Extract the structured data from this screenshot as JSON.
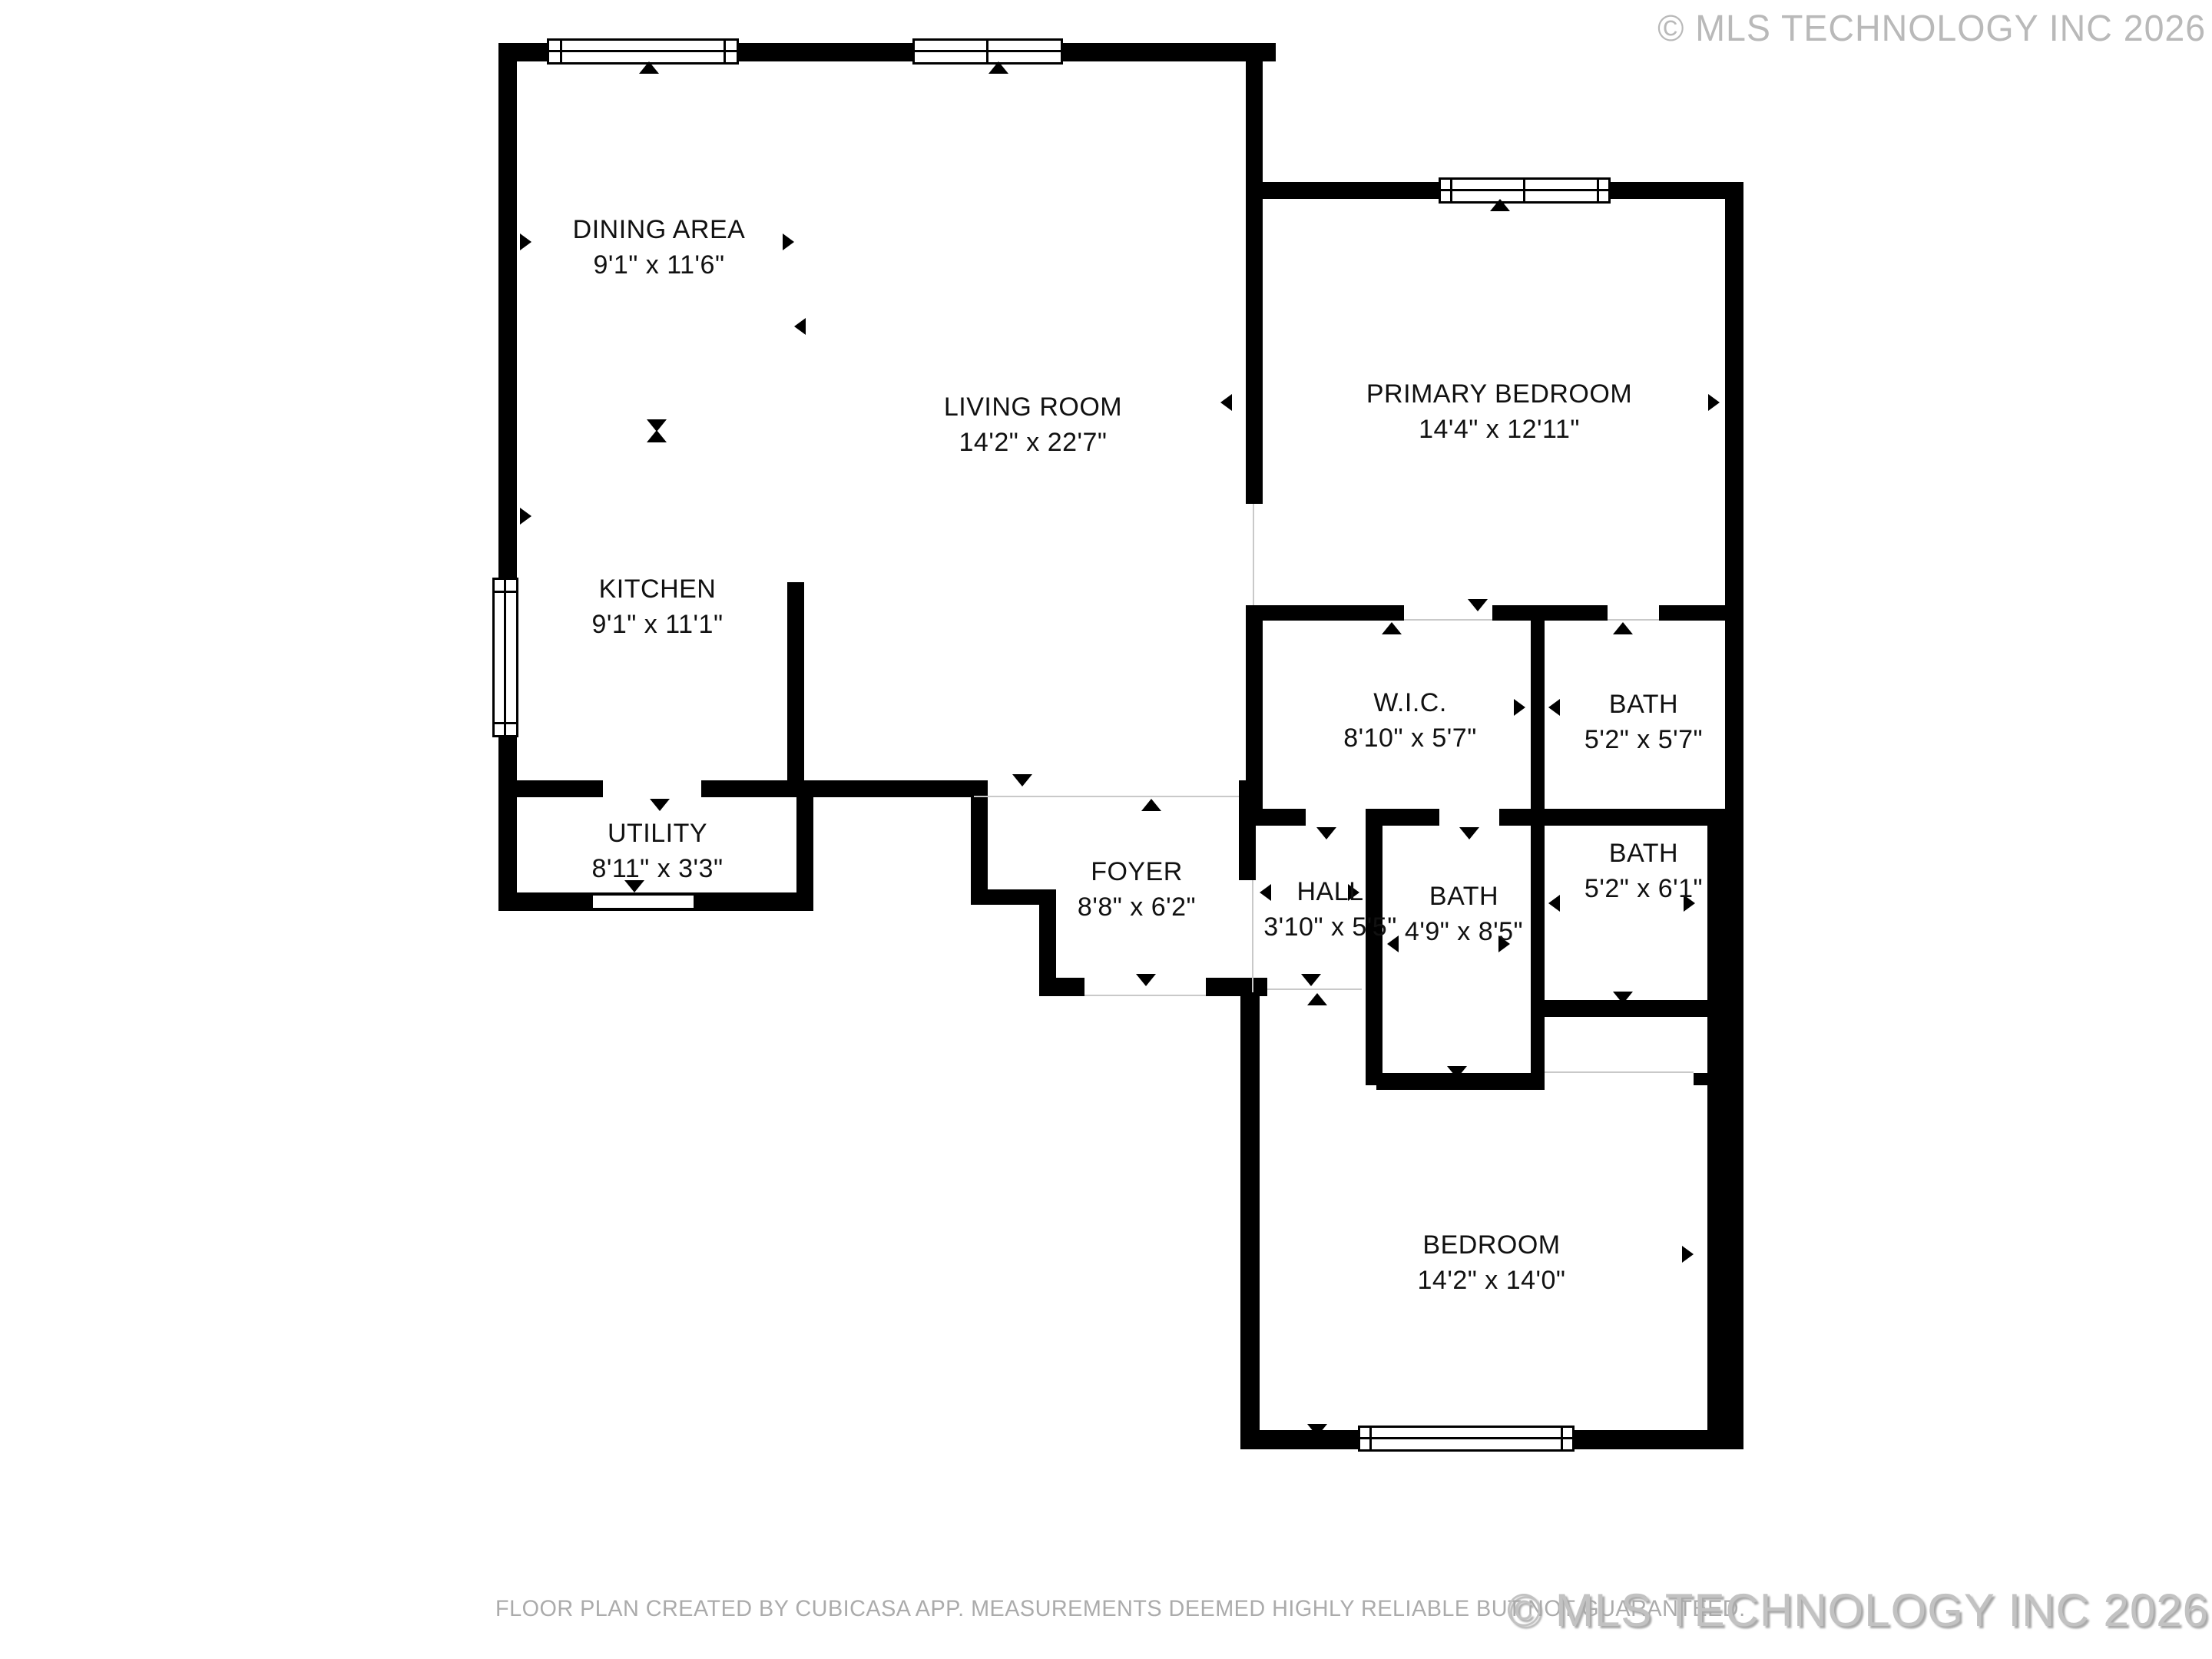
{
  "watermark_top": "© MLS TECHNOLOGY INC 2026",
  "watermark_bottom": "© MLS TECHNOLOGY INC 2026",
  "disclaimer": "FLOOR PLAN CREATED BY CUBICASA APP. MEASUREMENTS DEEMED HIGHLY RELIABLE BUT NOT GUARANTEED.",
  "rooms": [
    {
      "id": "dining",
      "name": "DINING AREA",
      "dims": "9'1\" x 11'6\""
    },
    {
      "id": "living",
      "name": "LIVING ROOM",
      "dims": "14'2\" x 22'7\""
    },
    {
      "id": "kitchen",
      "name": "KITCHEN",
      "dims": "9'1\" x 11'1\""
    },
    {
      "id": "utility",
      "name": "UTILITY",
      "dims": "8'11\" x 3'3\""
    },
    {
      "id": "foyer",
      "name": "FOYER",
      "dims": "8'8\" x 6'2\""
    },
    {
      "id": "hall",
      "name": "HALL",
      "dims": "3'10\" x 5'5\""
    },
    {
      "id": "bath1",
      "name": "BATH",
      "dims": "4'9\" x 8'5\""
    },
    {
      "id": "wic",
      "name": "W.I.C.",
      "dims": "8'10\" x 5'7\""
    },
    {
      "id": "bath2",
      "name": "BATH",
      "dims": "5'2\" x 5'7\""
    },
    {
      "id": "bath3",
      "name": "BATH",
      "dims": "5'2\" x 6'1\""
    },
    {
      "id": "primary",
      "name": "PRIMARY BEDROOM",
      "dims": "14'4\" x 12'11\""
    },
    {
      "id": "bedroom",
      "name": "BEDROOM",
      "dims": "14'2\" x 14'0\""
    }
  ],
  "colors": {
    "wall": "#000000",
    "room_separator_line": "#c9c9c9",
    "label_text": "#111111",
    "watermark": "#c2c2c2",
    "disclaimer": "#ababab"
  }
}
